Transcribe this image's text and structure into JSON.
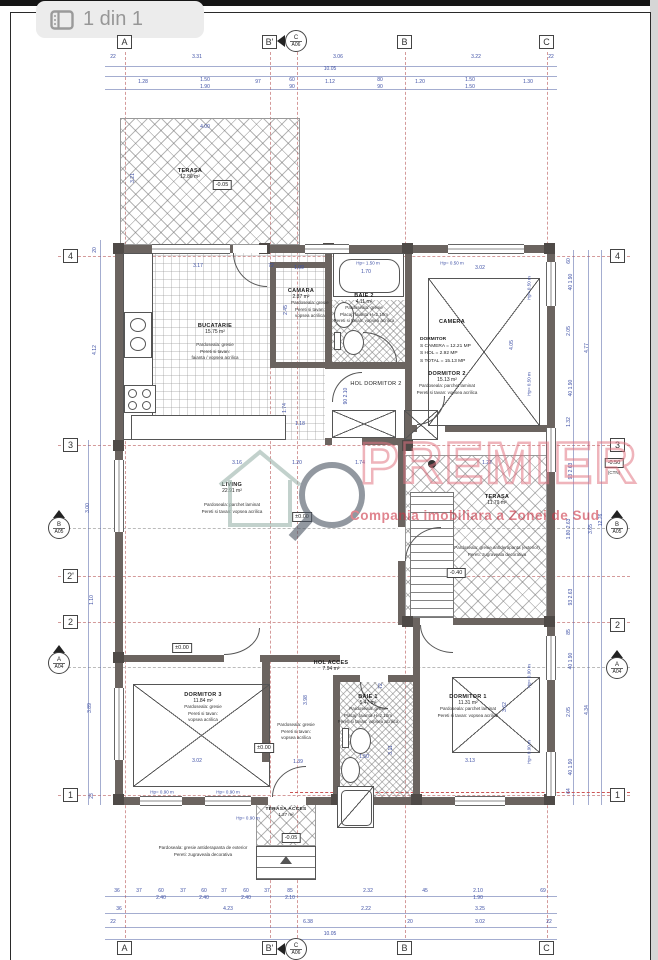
{
  "header": {
    "title": "1 din 1"
  },
  "watermark": {
    "brand": "PREMIER",
    "tagline": "Compania imobiliara a Zonei de Sud"
  },
  "axis": {
    "a": "A",
    "b1": "B'",
    "b": "B",
    "c": "C",
    "r4": "4",
    "r3": "3",
    "r2p": "2'",
    "r2": "2",
    "r1": "1",
    "mc_l": "C",
    "mc_c": "A06",
    "mb_l": "B",
    "mb_c": "A05",
    "ma_l": "A",
    "ma_c": "A04"
  },
  "levels": {
    "l1": "±0.00",
    "l2": "±0.00",
    "l3": "±0.00",
    "l4": "-0.05",
    "l5": "-0.05",
    "l6": "-0.40",
    "l7": "-0.50",
    "l7sub": "(CTN)"
  },
  "rooms": {
    "terasa_nw": {
      "name": "TERASA",
      "area": "12.86 m²"
    },
    "bucatarie": {
      "name": "BUCATARIE",
      "area": "15.75 m²",
      "f1": "Pardoseala: gresie",
      "f2": "Pereti si tavan:",
      "f3": "faianta / vopsea acrilica"
    },
    "camara": {
      "name": "CAMARA",
      "area": "2.87 m²",
      "f1": "Pardoseala: gresie",
      "f2": "Pereti si tavan:",
      "f3": "vopsea acrilica"
    },
    "baie2": {
      "name": "BAIE 2",
      "area": "4.11 m²",
      "f1": "Pardoseala: gresie",
      "f2": "Placaj: faianta H=2.10m",
      "f3": "Pereti si tavan: vopsea acrilica"
    },
    "camera": {
      "name": "CAMERA",
      "calc1": "DORMITOR",
      "calc2": "S CAMERA = 12.21 MP",
      "calc3": "S HOL = 2.92 MP",
      "calc4": "S TOTAL = 15.13 MP"
    },
    "dormitor2": {
      "name": "DORMITOR 2",
      "area": "15.13 m²",
      "f1": "Pardoseala: parchet laminat",
      "f2": "Pereti si tavan: vopsea acrilica"
    },
    "hol_dormitor2": {
      "name": "HOL DORMITOR 2"
    },
    "living": {
      "name": "LIVING",
      "area": "22.91 m²",
      "f1": "Pardoseala: parchet laminat",
      "f2": "Pereti si tavan: vopsea acrilica"
    },
    "terasa_e": {
      "name": "TERASA",
      "area": "11.79 m²",
      "f1": "Pardoseala: gresie antiderapanta (exterior)",
      "f2": "Pereti: zugraveala decorativa"
    },
    "dormitor3": {
      "name": "DORMITOR 3",
      "area": "11.84 m²",
      "f1": "Pardoseala: gresie",
      "f2": "Pereti si tavan:",
      "f3": "vopsea acrilica"
    },
    "hol_acces": {
      "name": "HOL ACCES",
      "area": "7.94 m²",
      "f1": "Pardoseala: gresie",
      "f2": "Pereti si tavan:",
      "f3": "vopsea acrilica"
    },
    "baie1": {
      "name": "BAIE 1",
      "area": "5.47 m²",
      "f1": "Pardoseala: gresie",
      "f2": "Placaj: faianta H=2.10m",
      "f3": "Pereti si tavan: vopsea acrilica"
    },
    "dormitor1": {
      "name": "DORMITOR 1",
      "area": "11.31 m²",
      "f1": "Pardoseala: parchet laminat",
      "f2": "Pereti si tavan: vopsea acrilica"
    },
    "terasa_acces": {
      "name": "TERASA ACCES",
      "area": "1.27 m²"
    },
    "exterior": {
      "f1": "Pardoseala: gresie antiderapanta de exterior",
      "f2": "Pereti: zugraveala decorativa"
    }
  },
  "dims": [
    {
      "t": "22",
      "x": 113,
      "y": 57
    },
    {
      "t": "3.31",
      "x": 197,
      "y": 57
    },
    {
      "t": "3.06",
      "x": 338,
      "y": 57
    },
    {
      "t": "3.22",
      "x": 476,
      "y": 57
    },
    {
      "t": "22",
      "x": 551,
      "y": 57
    },
    {
      "t": "10.05",
      "x": 330,
      "y": 69
    },
    {
      "t": "1.28",
      "x": 143,
      "y": 82
    },
    {
      "t": "1.50",
      "x": 205,
      "y": 80
    },
    {
      "t": "1.90",
      "x": 205,
      "y": 87
    },
    {
      "t": "97",
      "x": 258,
      "y": 82
    },
    {
      "t": "60",
      "x": 292,
      "y": 80
    },
    {
      "t": "90",
      "x": 292,
      "y": 87
    },
    {
      "t": "1.12",
      "x": 330,
      "y": 82
    },
    {
      "t": "80",
      "x": 380,
      "y": 80
    },
    {
      "t": "90",
      "x": 380,
      "y": 87
    },
    {
      "t": "1.20",
      "x": 420,
      "y": 82
    },
    {
      "t": "1.50",
      "x": 470,
      "y": 80
    },
    {
      "t": "1.50",
      "x": 470,
      "y": 87
    },
    {
      "t": "1.30",
      "x": 528,
      "y": 82
    },
    {
      "t": "36",
      "x": 117,
      "y": 891
    },
    {
      "t": "37",
      "x": 139,
      "y": 891
    },
    {
      "t": "60",
      "x": 161,
      "y": 891
    },
    {
      "t": "37",
      "x": 183,
      "y": 891
    },
    {
      "t": "60",
      "x": 204,
      "y": 891
    },
    {
      "t": "37",
      "x": 224,
      "y": 891
    },
    {
      "t": "60",
      "x": 246,
      "y": 891
    },
    {
      "t": "37",
      "x": 267,
      "y": 891
    },
    {
      "t": "85",
      "x": 290,
      "y": 891
    },
    {
      "t": "2.32",
      "x": 368,
      "y": 891
    },
    {
      "t": "45",
      "x": 425,
      "y": 891
    },
    {
      "t": "2.10",
      "x": 478,
      "y": 891
    },
    {
      "t": "69",
      "x": 543,
      "y": 891
    },
    {
      "t": "2.40",
      "x": 161,
      "y": 898
    },
    {
      "t": "2.40",
      "x": 204,
      "y": 898
    },
    {
      "t": "2.40",
      "x": 246,
      "y": 898
    },
    {
      "t": "2.10",
      "x": 290,
      "y": 898
    },
    {
      "t": "1.90",
      "x": 478,
      "y": 898
    },
    {
      "t": "36",
      "x": 119,
      "y": 909
    },
    {
      "t": "4.23",
      "x": 228,
      "y": 909
    },
    {
      "t": "2.22",
      "x": 366,
      "y": 909
    },
    {
      "t": "3.25",
      "x": 480,
      "y": 909
    },
    {
      "t": "22",
      "x": 113,
      "y": 922
    },
    {
      "t": "6.38",
      "x": 308,
      "y": 922
    },
    {
      "t": "20",
      "x": 410,
      "y": 922
    },
    {
      "t": "3.02",
      "x": 480,
      "y": 922
    },
    {
      "t": "22",
      "x": 549,
      "y": 922
    },
    {
      "t": "10.05",
      "x": 330,
      "y": 934
    },
    {
      "t": "20",
      "x": 95,
      "y": 250,
      "v": 1
    },
    {
      "t": "4.12",
      "x": 95,
      "y": 350,
      "v": 1
    },
    {
      "t": "3.00",
      "x": 88,
      "y": 508,
      "v": 1
    },
    {
      "t": "1.10",
      "x": 92,
      "y": 600,
      "v": 1
    },
    {
      "t": "3.89",
      "x": 90,
      "y": 708,
      "v": 1
    },
    {
      "t": "23",
      "x": 92,
      "y": 796,
      "v": 1
    },
    {
      "t": "60",
      "x": 569,
      "y": 261,
      "v": 1
    },
    {
      "t": "40 1.90",
      "x": 571,
      "y": 282,
      "v": 1
    },
    {
      "t": "2.05",
      "x": 569,
      "y": 331,
      "v": 1
    },
    {
      "t": "4.77",
      "x": 587,
      "y": 348,
      "v": 1
    },
    {
      "t": "40 1.90",
      "x": 571,
      "y": 388,
      "v": 1
    },
    {
      "t": "1.32",
      "x": 569,
      "y": 422,
      "v": 1
    },
    {
      "t": "93 2.63",
      "x": 571,
      "y": 471,
      "v": 1
    },
    {
      "t": "1.80 2.63",
      "x": 569,
      "y": 529,
      "v": 1
    },
    {
      "t": "3.65",
      "x": 591,
      "y": 529,
      "v": 1
    },
    {
      "t": "12.76",
      "x": 601,
      "y": 520,
      "v": 1
    },
    {
      "t": "93 2.63",
      "x": 571,
      "y": 597,
      "v": 1
    },
    {
      "t": "85",
      "x": 569,
      "y": 632,
      "v": 1
    },
    {
      "t": "40 1.90",
      "x": 571,
      "y": 661,
      "v": 1
    },
    {
      "t": "2.05",
      "x": 569,
      "y": 712,
      "v": 1
    },
    {
      "t": "4.34",
      "x": 587,
      "y": 710,
      "v": 1
    },
    {
      "t": "40 1.90",
      "x": 571,
      "y": 767,
      "v": 1
    },
    {
      "t": "64",
      "x": 569,
      "y": 791,
      "v": 1
    },
    {
      "t": "3.17",
      "x": 198,
      "y": 266
    },
    {
      "t": "72",
      "x": 271,
      "y": 266
    },
    {
      "t": "1.09",
      "x": 299,
      "y": 268
    },
    {
      "t": "1.70",
      "x": 366,
      "y": 272
    },
    {
      "t": "3.02",
      "x": 480,
      "y": 268
    },
    {
      "t": "2.45",
      "x": 286,
      "y": 310,
      "v": 1
    },
    {
      "t": "1.74",
      "x": 285,
      "y": 408,
      "v": 1
    },
    {
      "t": "1.18",
      "x": 300,
      "y": 424
    },
    {
      "t": "4.05",
      "x": 512,
      "y": 345,
      "v": 1
    },
    {
      "t": "90 2.10",
      "x": 346,
      "y": 396,
      "v": 1
    },
    {
      "t": "3.16",
      "x": 237,
      "y": 463
    },
    {
      "t": "1.20",
      "x": 297,
      "y": 463
    },
    {
      "t": "1.74",
      "x": 360,
      "y": 463
    },
    {
      "t": "1.22",
      "x": 487,
      "y": 463
    },
    {
      "t": "4.00",
      "x": 205,
      "y": 127
    },
    {
      "t": "3.21",
      "x": 133,
      "y": 178,
      "v": 1
    },
    {
      "t": "3.02",
      "x": 197,
      "y": 761
    },
    {
      "t": "1.39",
      "x": 298,
      "y": 762
    },
    {
      "t": "1.50",
      "x": 364,
      "y": 757
    },
    {
      "t": "72",
      "x": 381,
      "y": 686,
      "v": 1
    },
    {
      "t": "3.11",
      "x": 391,
      "y": 750,
      "v": 1
    },
    {
      "t": "3.13",
      "x": 470,
      "y": 761
    },
    {
      "t": "3.62",
      "x": 505,
      "y": 707,
      "v": 1
    },
    {
      "t": "3.98",
      "x": 306,
      "y": 700,
      "v": 1
    }
  ],
  "hp": [
    {
      "t": "Hp= 1.50 m",
      "x": 368,
      "y": 263
    },
    {
      "t": "Hp= 0.50 m",
      "x": 452,
      "y": 263
    },
    {
      "t": "Hp= 0.50 m",
      "x": 529,
      "y": 288,
      "v": 1
    },
    {
      "t": "Hp= 0.50 m",
      "x": 529,
      "y": 384,
      "v": 1
    },
    {
      "t": "Hp= 0.90 m",
      "x": 162,
      "y": 792
    },
    {
      "t": "Hp= 0.90 m",
      "x": 228,
      "y": 792
    },
    {
      "t": "Hp= 0.90 m",
      "x": 248,
      "y": 818
    },
    {
      "t": "Hp= 0.90 m",
      "x": 529,
      "y": 676,
      "v": 1
    },
    {
      "t": "Hp= 0.90 m",
      "x": 529,
      "y": 752,
      "v": 1
    }
  ]
}
